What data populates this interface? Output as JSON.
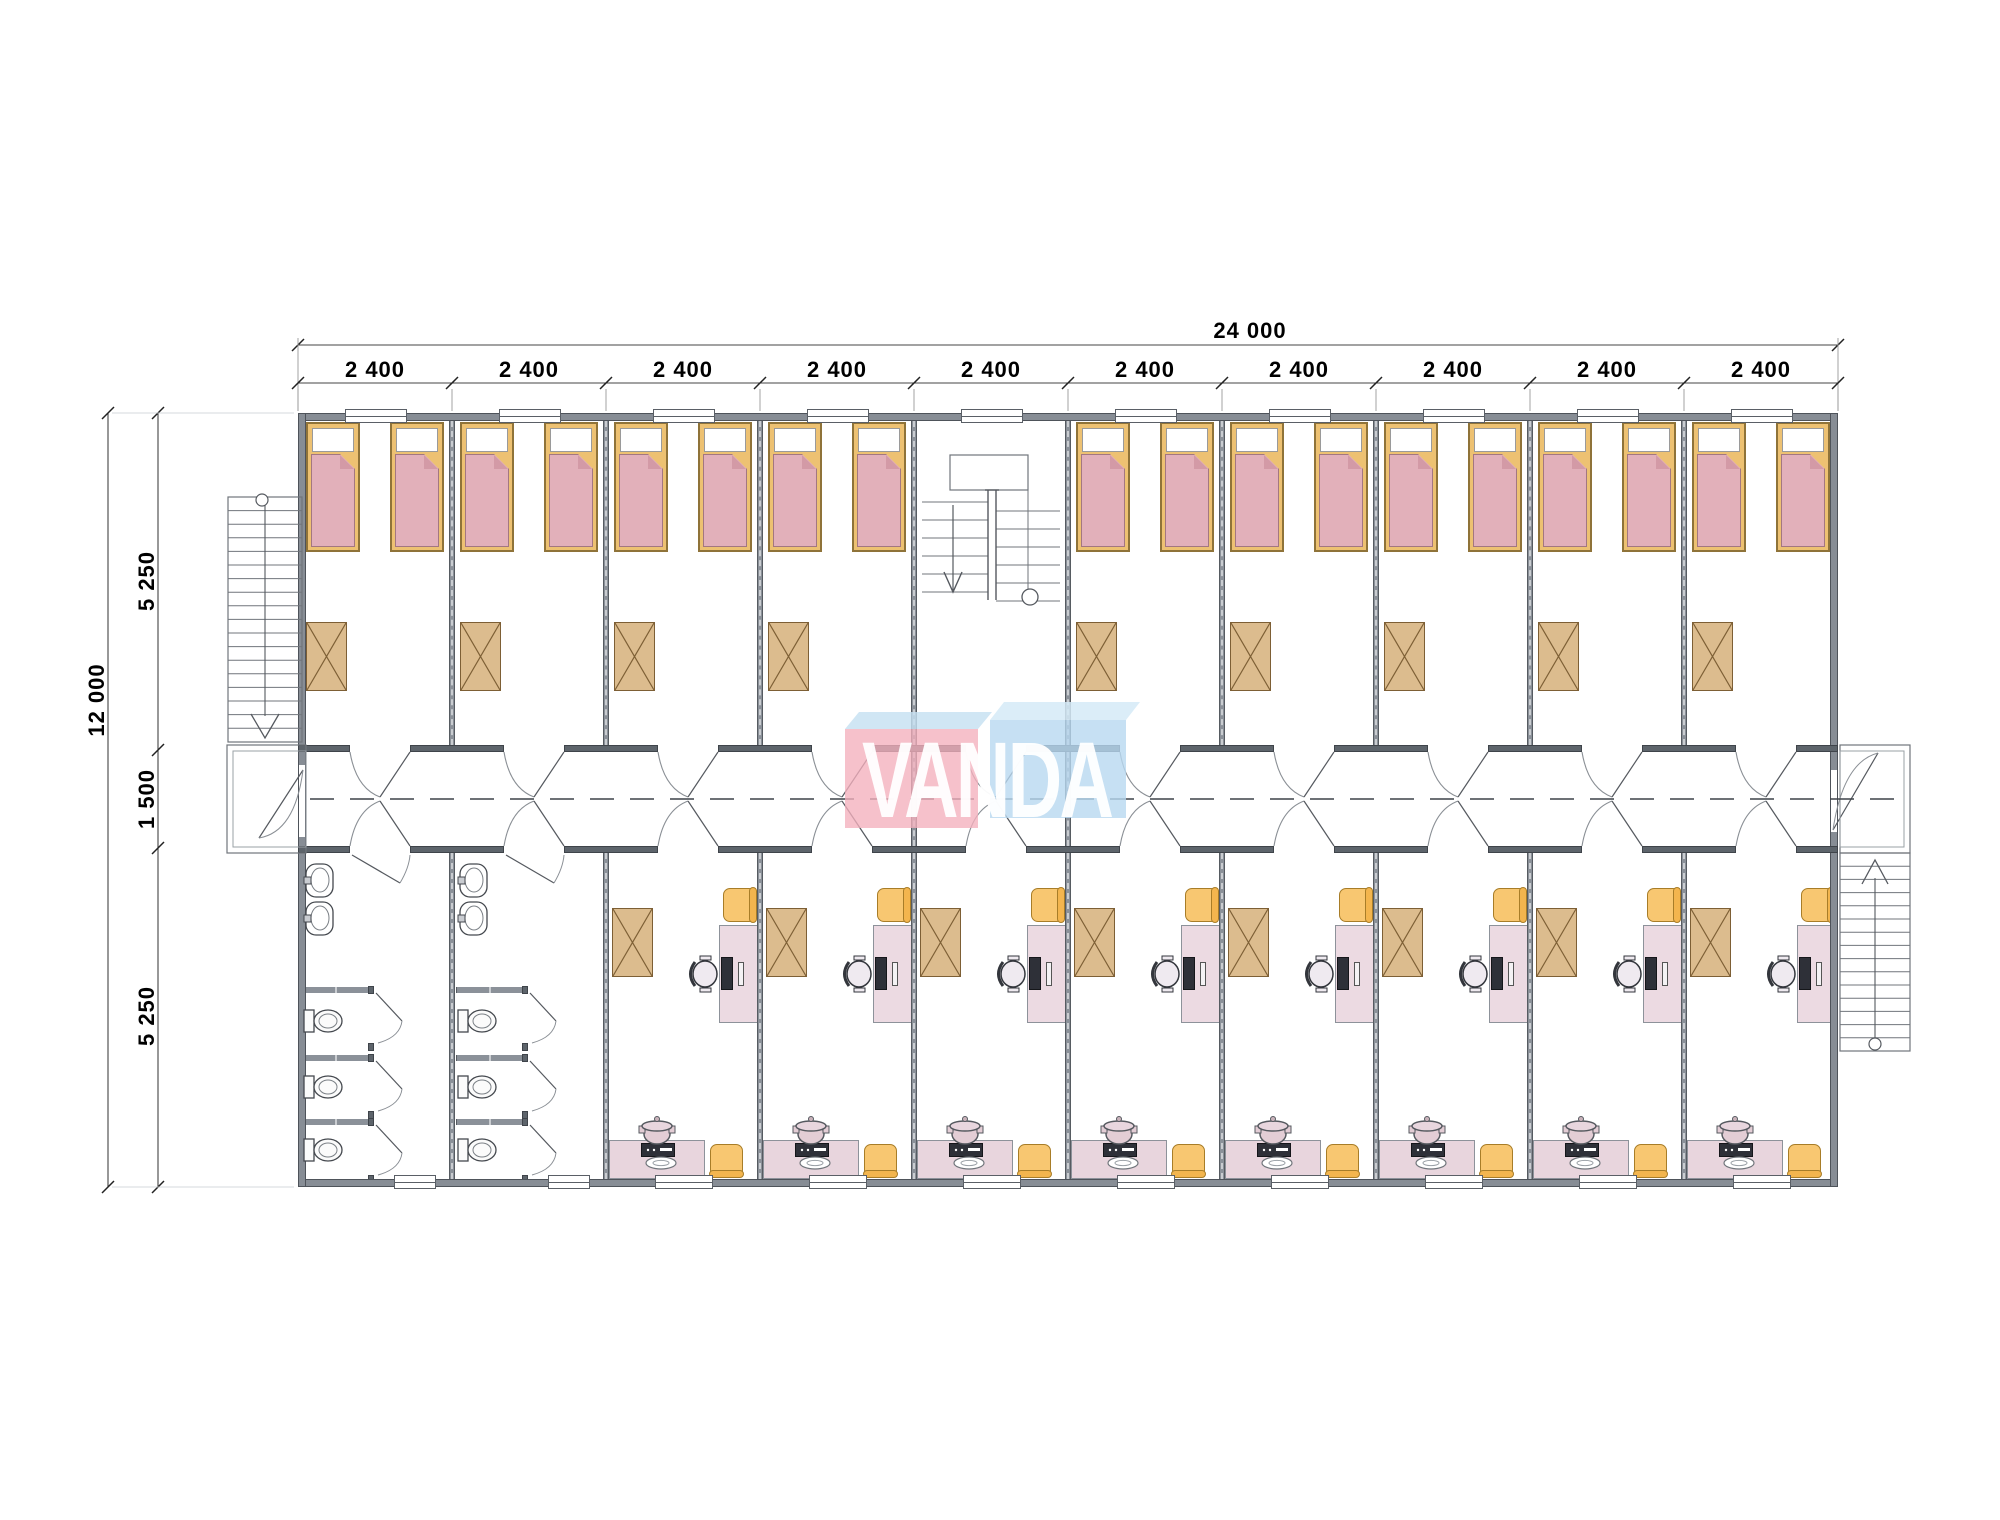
{
  "title": "VANDA modular building floor plan",
  "watermark": {
    "text": "VANDA"
  },
  "dimensions": {
    "total_width_label": "24 000",
    "bay_width_labels": [
      "2 400",
      "2 400",
      "2 400",
      "2 400",
      "2 400",
      "2 400",
      "2 400",
      "2 400",
      "2 400",
      "2 400"
    ],
    "total_depth_label": "12 000",
    "depth_segment_labels": [
      "5 250",
      "1 500",
      "5 250"
    ]
  },
  "building": {
    "bays": [
      {
        "top": "bedroom",
        "bottom": "bathroom"
      },
      {
        "top": "bedroom",
        "bottom": "bathroom"
      },
      {
        "top": "bedroom",
        "bottom": "office"
      },
      {
        "top": "bedroom",
        "bottom": "office"
      },
      {
        "top": "stairwell",
        "bottom": "office"
      },
      {
        "top": "bedroom",
        "bottom": "office"
      },
      {
        "top": "bedroom",
        "bottom": "office"
      },
      {
        "top": "bedroom",
        "bottom": "office"
      },
      {
        "top": "bedroom",
        "bottom": "office"
      },
      {
        "top": "bedroom",
        "bottom": "office"
      }
    ],
    "features": [
      "left exterior stair",
      "left entry porch",
      "central stairwell",
      "right entry landing",
      "right exterior stair",
      "corridor center line"
    ]
  },
  "colors": {
    "wall": "#878d95",
    "wall_edge": "#4e535a",
    "bed_frame": "#edc172",
    "blanket": "#e2b0ba",
    "wardrobe": "#dcbc8e",
    "desk": "#ecdae2",
    "accent_chair": "#f8c771",
    "appliance": "#2e3038",
    "linework": "#5c6167",
    "watermark_pink": "rgba(244,176,189,0.78)",
    "watermark_pink_top": "rgba(198,224,242,0.82)",
    "watermark_blue": "rgba(184,216,240,0.80)",
    "watermark_blue_top": "rgba(213,234,247,0.85)",
    "watermark_text": "rgba(255,255,255,0.95)"
  }
}
